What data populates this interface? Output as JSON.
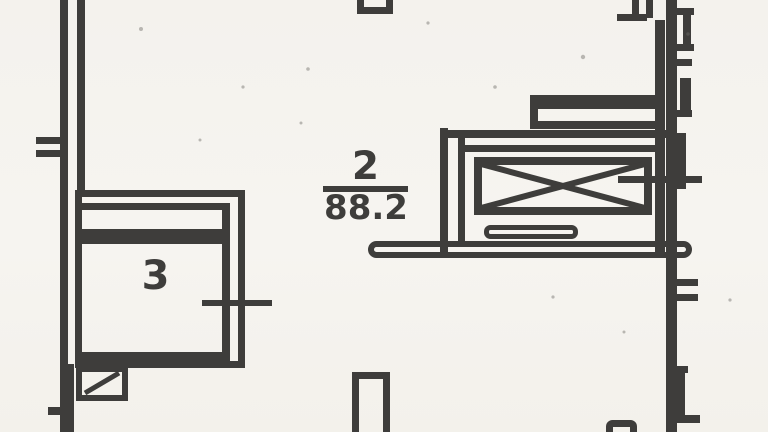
{
  "title": "Scanned apartment floor plan fragment",
  "colors": {
    "paper": "#f3f1ec",
    "ink": "#3f3e3c"
  },
  "rooms": [
    {
      "id": "room-3",
      "number": "3"
    },
    {
      "id": "room-2",
      "number": "2",
      "area": "88.2"
    }
  ]
}
